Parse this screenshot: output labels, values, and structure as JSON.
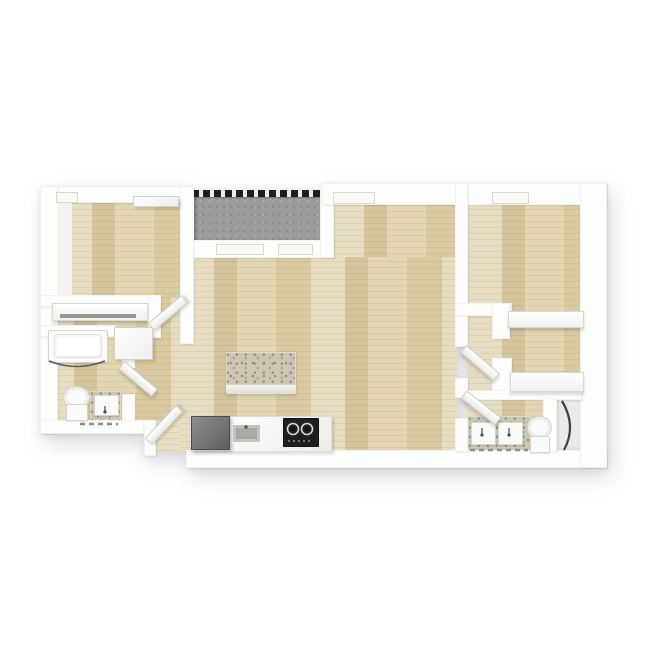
{
  "scene": {
    "type": "3d-floor-plan-render",
    "view": "top-down",
    "style": "white walls, light wood plank flooring, no text labels",
    "background": "#ffffff"
  },
  "colors": {
    "background": "#ffffff",
    "wall": "#fdfdfc",
    "wall_shadow": "#d9d9d4",
    "wood_floor": "#ddcfa7",
    "wood_streak_dark": "#c9b98e",
    "balcony_concrete": "#9a9a98",
    "railing_dark": "#1f1f1f",
    "granite_counter": "#ccc5b3",
    "appliance_gray": "#6f6f6d",
    "stove_black": "#201f1d",
    "fixture_white": "#fafaf8",
    "glass_dark": "#3e3e3c"
  },
  "rooms": [
    {
      "id": "bedroom-1",
      "position": "top-left",
      "floor": "wood"
    },
    {
      "id": "closet-1",
      "position": "left, below bedroom-1",
      "floor": "wood"
    },
    {
      "id": "bathroom-1",
      "position": "bottom-left",
      "floor": "wood"
    },
    {
      "id": "hallway",
      "position": "center-left",
      "floor": "wood"
    },
    {
      "id": "kitchen",
      "position": "bottom-center",
      "floor": "wood"
    },
    {
      "id": "living-dining",
      "position": "center",
      "floor": "wood"
    },
    {
      "id": "balcony",
      "position": "top-center",
      "floor": "concrete"
    },
    {
      "id": "bedroom-2",
      "position": "top-right",
      "floor": "wood"
    },
    {
      "id": "closet-2",
      "position": "right, below bedroom-2",
      "floor": "wood"
    },
    {
      "id": "bathroom-2",
      "position": "bottom-right",
      "floor": "wood"
    }
  ],
  "fixtures": [
    "bathtub with curved shower-curtain rod (bathroom-1)",
    "toilet (bathroom-1)",
    "single sink vanity (bathroom-1)",
    "utility cabinet box (hallway nook)",
    "closet shelf with rod (closet-1)",
    "double sink vanity (bathroom-2)",
    "toilet (bathroom-2)",
    "corner shower with curved glass door (bathroom-2)",
    "two closet shelves (closet-2)"
  ],
  "appliances": [
    "refrigerator",
    "kitchen sink",
    "cooktop stove with two visible burners",
    "granite kitchen counter",
    "granite kitchen island"
  ],
  "doors": [
    {
      "id": "entry-door",
      "state": "open 45deg"
    },
    {
      "id": "bedroom-1-door",
      "state": "open 45deg"
    },
    {
      "id": "bathroom-1-door",
      "state": "open 45deg"
    },
    {
      "id": "bedroom-2-door",
      "state": "open 45deg"
    },
    {
      "id": "bathroom-2-door",
      "state": "open 45deg"
    }
  ],
  "windows": [
    {
      "id": "bedroom-1-window",
      "wall": "top"
    },
    {
      "id": "living-room-window",
      "wall": "top"
    },
    {
      "id": "bedroom-2-window",
      "wall": "top"
    },
    {
      "id": "balcony-sliding-door",
      "wall": "balcony bottom"
    }
  ],
  "balcony": {
    "railing": "black segmented railing along top edge"
  }
}
